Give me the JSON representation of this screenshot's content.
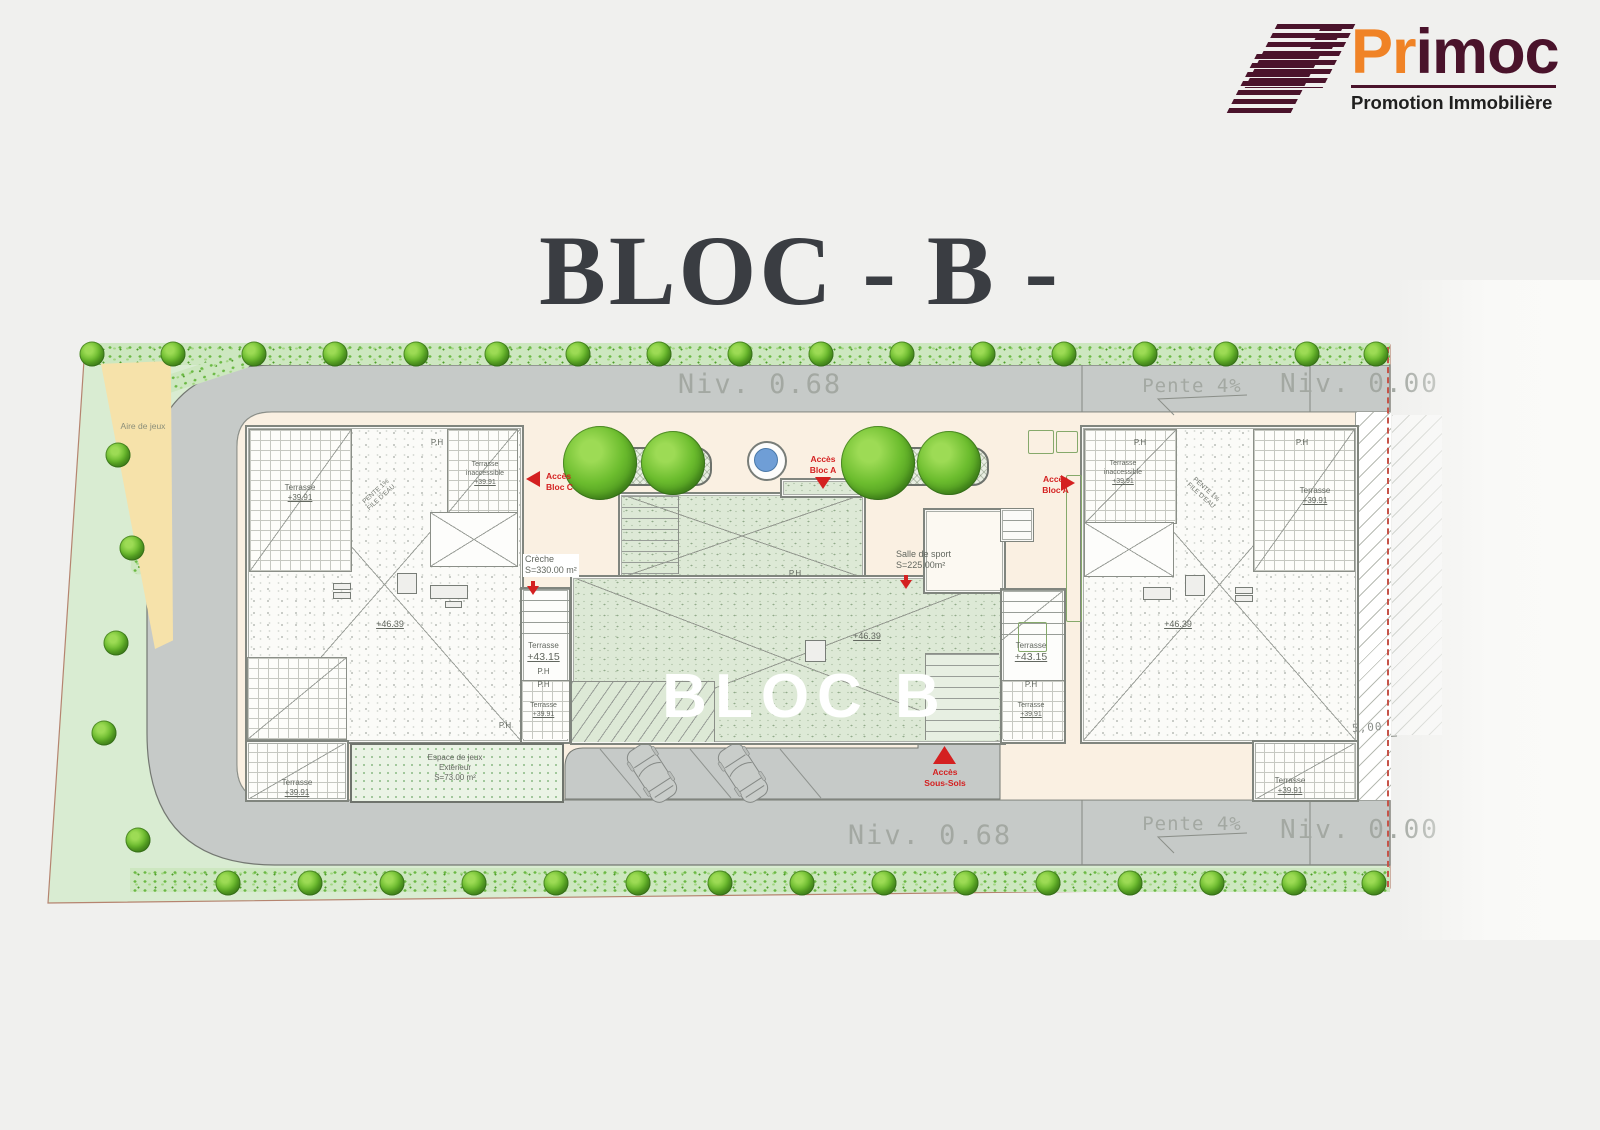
{
  "title": "BLOC - B -",
  "logo": {
    "brand_prefix": "Pr",
    "brand_suffix": "imoc",
    "tagline": "Promotion Immobilière"
  },
  "colors": {
    "brand_orange": "#f08326",
    "brand_maroon": "#4a132b",
    "access_red": "#d42020",
    "road_gray": "#c6cac8",
    "courtyard_cream": "#faf0e2",
    "site_green": "#d9ecd2"
  },
  "road": {
    "niv_068": "Niv. 0.68",
    "niv_000": "Niv. 0.00",
    "pente": "Pente 4%"
  },
  "dim_5": "5,00",
  "bloc_b": "BLOC B",
  "access": {
    "acces": "Accès",
    "bloc_c": "Bloc C",
    "bloc_a": "Bloc A",
    "sous_sols": "Sous-Sols"
  },
  "areas": {
    "creche": "Crèche",
    "creche_s": "S=330.00 m²",
    "salle": "Salle de sport",
    "salle_s": "S=225.00m²",
    "espace": "Espace de jeux",
    "espace_2": "Extérieur",
    "espace_s": "S=73.00 m²",
    "aire": "Aire de jeux"
  },
  "roof": {
    "terrasse": "Terrasse",
    "inaccessible": "inaccessible",
    "v3991": "+39.91",
    "v4315": "+43.15",
    "v4639": "+46.39",
    "ph": "P.H",
    "pente1": "PENTE 1%",
    "file": "FILE D'EAU"
  }
}
